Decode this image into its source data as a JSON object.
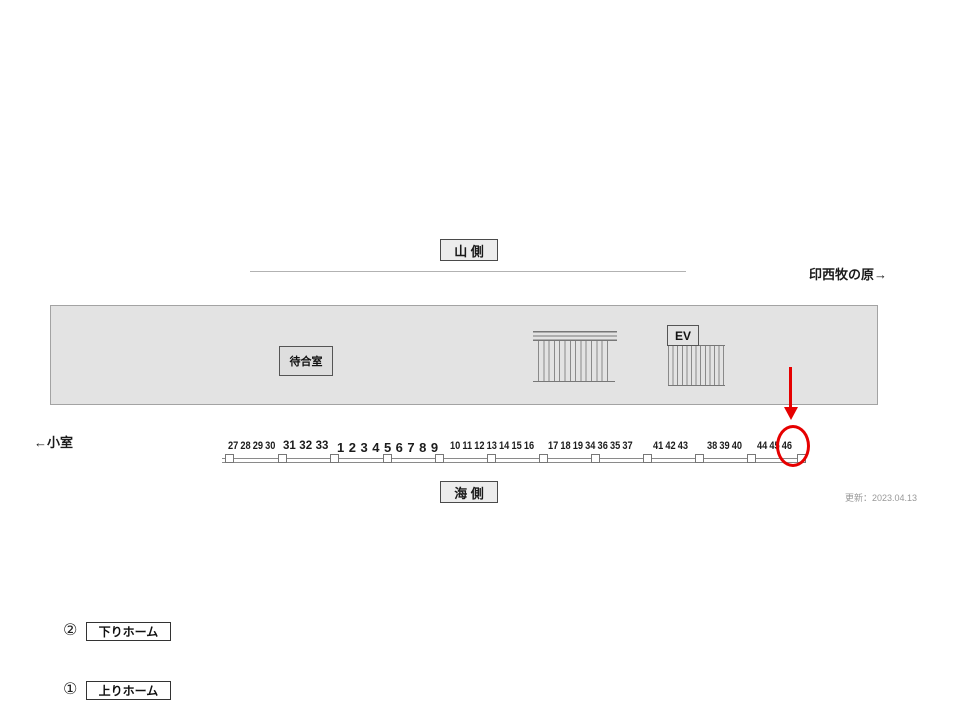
{
  "diagram": {
    "top_label": "山 側",
    "bottom_label": "海 側",
    "right_direction": "印西牧の原→",
    "left_direction": "←小室",
    "updated_label": "更新：2023.04.13",
    "platform": {
      "tracks": [
        {
          "badge": "②",
          "label": "下りホーム"
        },
        {
          "badge": "①",
          "label": "上りホーム"
        }
      ],
      "waiting_room_label": "待合室",
      "elevator_label": "EV"
    },
    "ad_numbers": {
      "groups": [
        {
          "style": "condensed",
          "values": [
            "27",
            "28",
            "29",
            "30"
          ]
        },
        {
          "style": "bold",
          "values": [
            "31",
            "32",
            "33"
          ]
        },
        {
          "style": "bold-large",
          "values": [
            "1",
            "2",
            "3",
            "4",
            "5",
            "6",
            "7",
            "8",
            "9"
          ]
        },
        {
          "style": "condensed",
          "values": [
            "10",
            "11",
            "12",
            "13",
            "14",
            "15",
            "16"
          ]
        },
        {
          "style": "condensed",
          "values": [
            "17",
            "18",
            "19",
            "34",
            "36",
            "35",
            "37"
          ]
        },
        {
          "style": "condensed",
          "values": [
            "41",
            "42",
            "43"
          ]
        },
        {
          "style": "condensed",
          "values": [
            "38",
            "39",
            "40"
          ]
        },
        {
          "style": "condensed",
          "values": [
            "44",
            "45",
            "46"
          ]
        }
      ],
      "highlighted": "46"
    },
    "colors": {
      "highlight_red": "#e60000",
      "platform_fill": "#e3e3e3",
      "platform_border": "#a3a3a3",
      "line_gray": "#8a8a8a"
    }
  }
}
